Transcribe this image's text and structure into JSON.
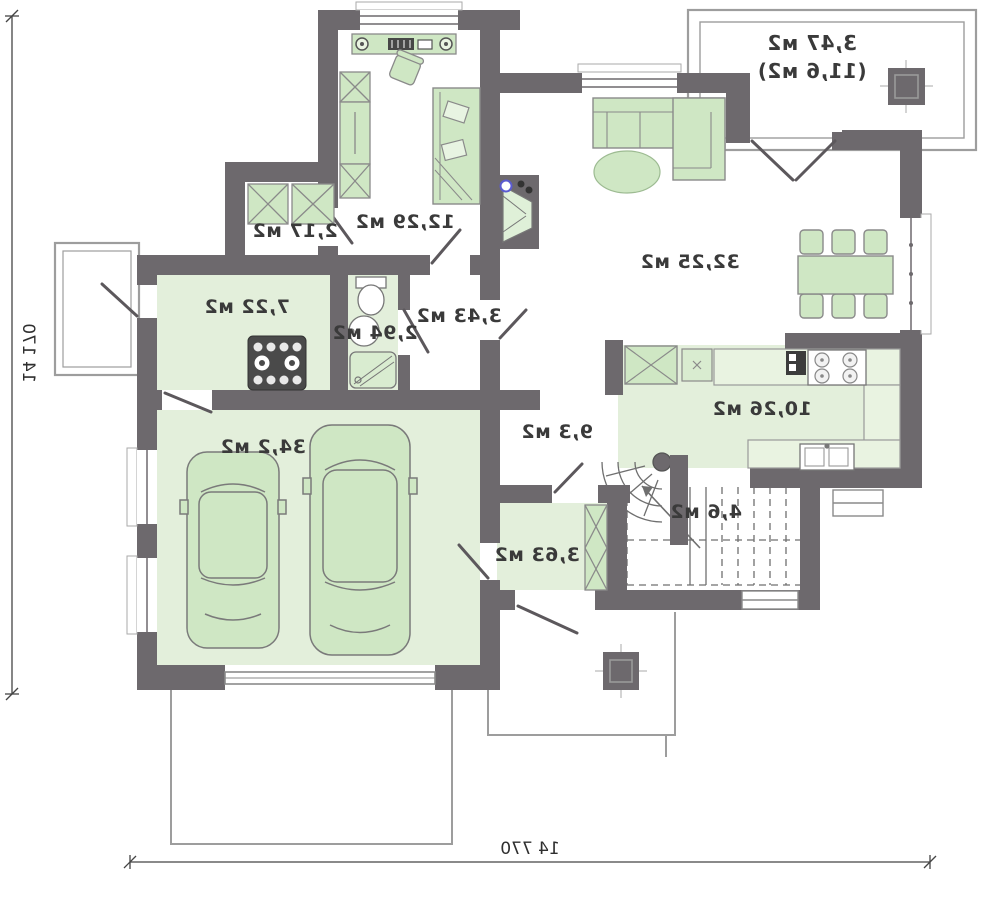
{
  "plan": {
    "title": "first-floor-plan-mirrored",
    "rooms": [
      {
        "name": "terrace",
        "area": "3,47 м2",
        "area_total": "(11,6 м2)"
      },
      {
        "name": "study",
        "area": "12,29 м2"
      },
      {
        "name": "wardrobe",
        "area": "2,17 м2"
      },
      {
        "name": "living-room",
        "area": "32,25 м2"
      },
      {
        "name": "utility-room",
        "area": "7,22 м2"
      },
      {
        "name": "bathroom",
        "area": "2,94 м2"
      },
      {
        "name": "hall",
        "area": "3,43 м2"
      },
      {
        "name": "corridor",
        "area": "9,3 м2"
      },
      {
        "name": "kitchen",
        "area": "10,26 м2"
      },
      {
        "name": "stairs",
        "area": "4,6 м2"
      },
      {
        "name": "entry",
        "area": "3,63 м2"
      },
      {
        "name": "garage",
        "area": "34,2 м2"
      }
    ],
    "dimensions": {
      "height": "14 170",
      "width": "14 770"
    },
    "colors": {
      "wall": "#6d696d",
      "room_fill": "#e3efdb",
      "furniture_fill": "#cfe7c4",
      "counter_fill": "#e9f3e1",
      "thin_line": "#9d9d9d"
    }
  }
}
